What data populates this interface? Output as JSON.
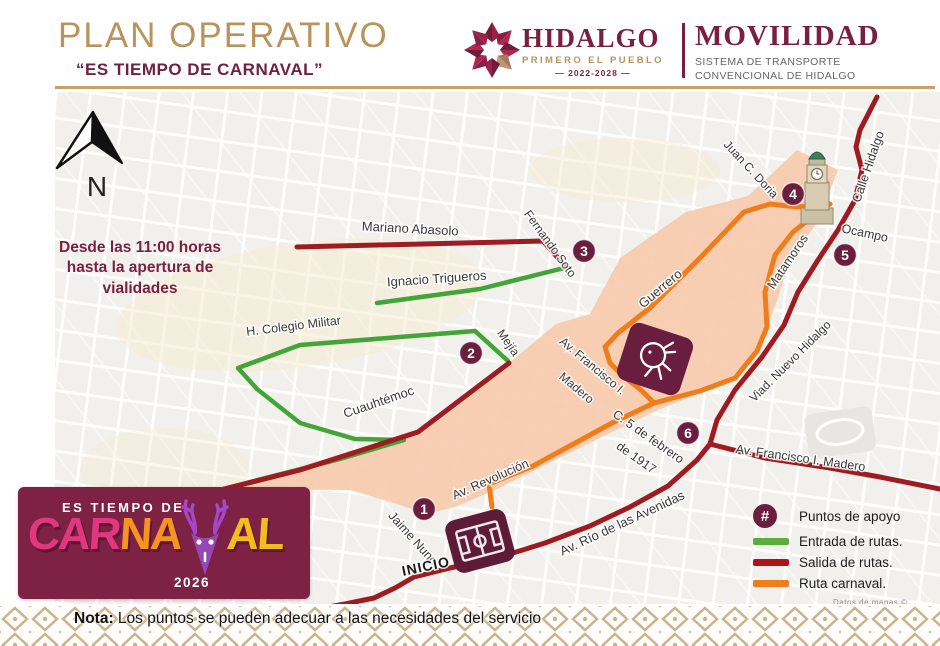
{
  "header": {
    "title": "PLAN OPERATIVO",
    "subtitle": "“ES TIEMPO DE CARNAVAL”"
  },
  "brand": {
    "hidalgo": "HIDALGO",
    "tagline": "PRIMERO EL PUEBLO",
    "years": "— 2022-2028 —",
    "agency": "MOVILIDAD",
    "agency_line1": "SISTEMA DE TRANSPORTE",
    "agency_line2": "CONVENCIONAL DE HIDALGO"
  },
  "map": {
    "north_label": "N",
    "notice": "Desde las 11:00 horas hasta la apertura de vialidades",
    "inicio_label": "INICIO",
    "attribution": "Datos de mapas ©",
    "streets": [
      {
        "name": "Mariano Abasolo",
        "x": 410,
        "y": 233,
        "rot": 3,
        "size": 13
      },
      {
        "name": "Fernando Soto",
        "x": 547,
        "y": 246,
        "rot": 54,
        "size": 12
      },
      {
        "name": "Ignacio Trigueros",
        "x": 437,
        "y": 283,
        "rot": -4,
        "size": 13
      },
      {
        "name": "H. Colegio Militar",
        "x": 294,
        "y": 330,
        "rot": -7,
        "size": 12.5
      },
      {
        "name": "Mejía",
        "x": 505,
        "y": 345,
        "rot": 55,
        "size": 12
      },
      {
        "name": "Cuauhtémoc",
        "x": 380,
        "y": 406,
        "rot": -19,
        "size": 13
      },
      {
        "name": "Guerrero",
        "x": 663,
        "y": 292,
        "rot": -40,
        "size": 13
      },
      {
        "name": "Matamoros",
        "x": 791,
        "y": 264,
        "rot": -56,
        "size": 12.5
      },
      {
        "name": "Juan C. Doria",
        "x": 748,
        "y": 172,
        "rot": 47,
        "size": 12
      },
      {
        "name": "Calle Hidalgo",
        "x": 872,
        "y": 168,
        "rot": -71,
        "size": 12.5
      },
      {
        "name": "Ocampo",
        "x": 864,
        "y": 237,
        "rot": 12,
        "size": 12.5
      },
      {
        "name": "Viad. Nuevo Hidalgo",
        "x": 793,
        "y": 364,
        "rot": -45,
        "size": 12
      },
      {
        "name": "Av. Francisco I. Madero",
        "x": 800,
        "y": 462,
        "rot": 8,
        "size": 12.5
      },
      {
        "name": "Av. Francisco I.",
        "x": 590,
        "y": 369,
        "rot": 40,
        "size": 12
      },
      {
        "name": "Madero",
        "x": 574,
        "y": 391,
        "rot": 40,
        "size": 12
      },
      {
        "name": "C. 5 de febrero",
        "x": 646,
        "y": 440,
        "rot": 35,
        "size": 12.5
      },
      {
        "name": "de 1917",
        "x": 634,
        "y": 461,
        "rot": 35,
        "size": 12.5
      },
      {
        "name": "Av. Revolución",
        "x": 492,
        "y": 483,
        "rot": -24,
        "size": 12.5
      },
      {
        "name": "Jaime Nuno",
        "x": 410,
        "y": 541,
        "rot": 48,
        "size": 12.5
      },
      {
        "name": "Av. Río de las Avenidas",
        "x": 624,
        "y": 527,
        "rot": -25,
        "size": 13
      }
    ],
    "points": [
      {
        "label": "1",
        "x": 424,
        "y": 509
      },
      {
        "label": "2",
        "x": 471,
        "y": 353
      },
      {
        "label": "3",
        "x": 584,
        "y": 251
      },
      {
        "label": "4",
        "x": 793,
        "y": 194
      },
      {
        "label": "5",
        "x": 845,
        "y": 255
      },
      {
        "label": "6",
        "x": 688,
        "y": 433
      }
    ]
  },
  "legend": {
    "symbol": "#",
    "points_label": "Puntos de apoyo",
    "entry_label": "Entrada de rutas.",
    "exit_label": "Salida de rutas.",
    "carnival_label": "Ruta carnaval."
  },
  "carnival_logo": {
    "top_line": "ES TIEMPO DE",
    "part1": "CAR",
    "part2": "NA",
    "part3": "AL",
    "year": "2026"
  },
  "note": {
    "bold": "Nota:",
    "text": " Los puntos se pueden adecuar a las necesidades del servicio"
  },
  "colors": {
    "gold": "#BA9459",
    "maroon": "#6B1F3E",
    "entry_green": "#43A437",
    "exit_red": "#9E1B22",
    "carnival_orange": "#F07D1C",
    "zone_peach": "#F7C8AA"
  }
}
